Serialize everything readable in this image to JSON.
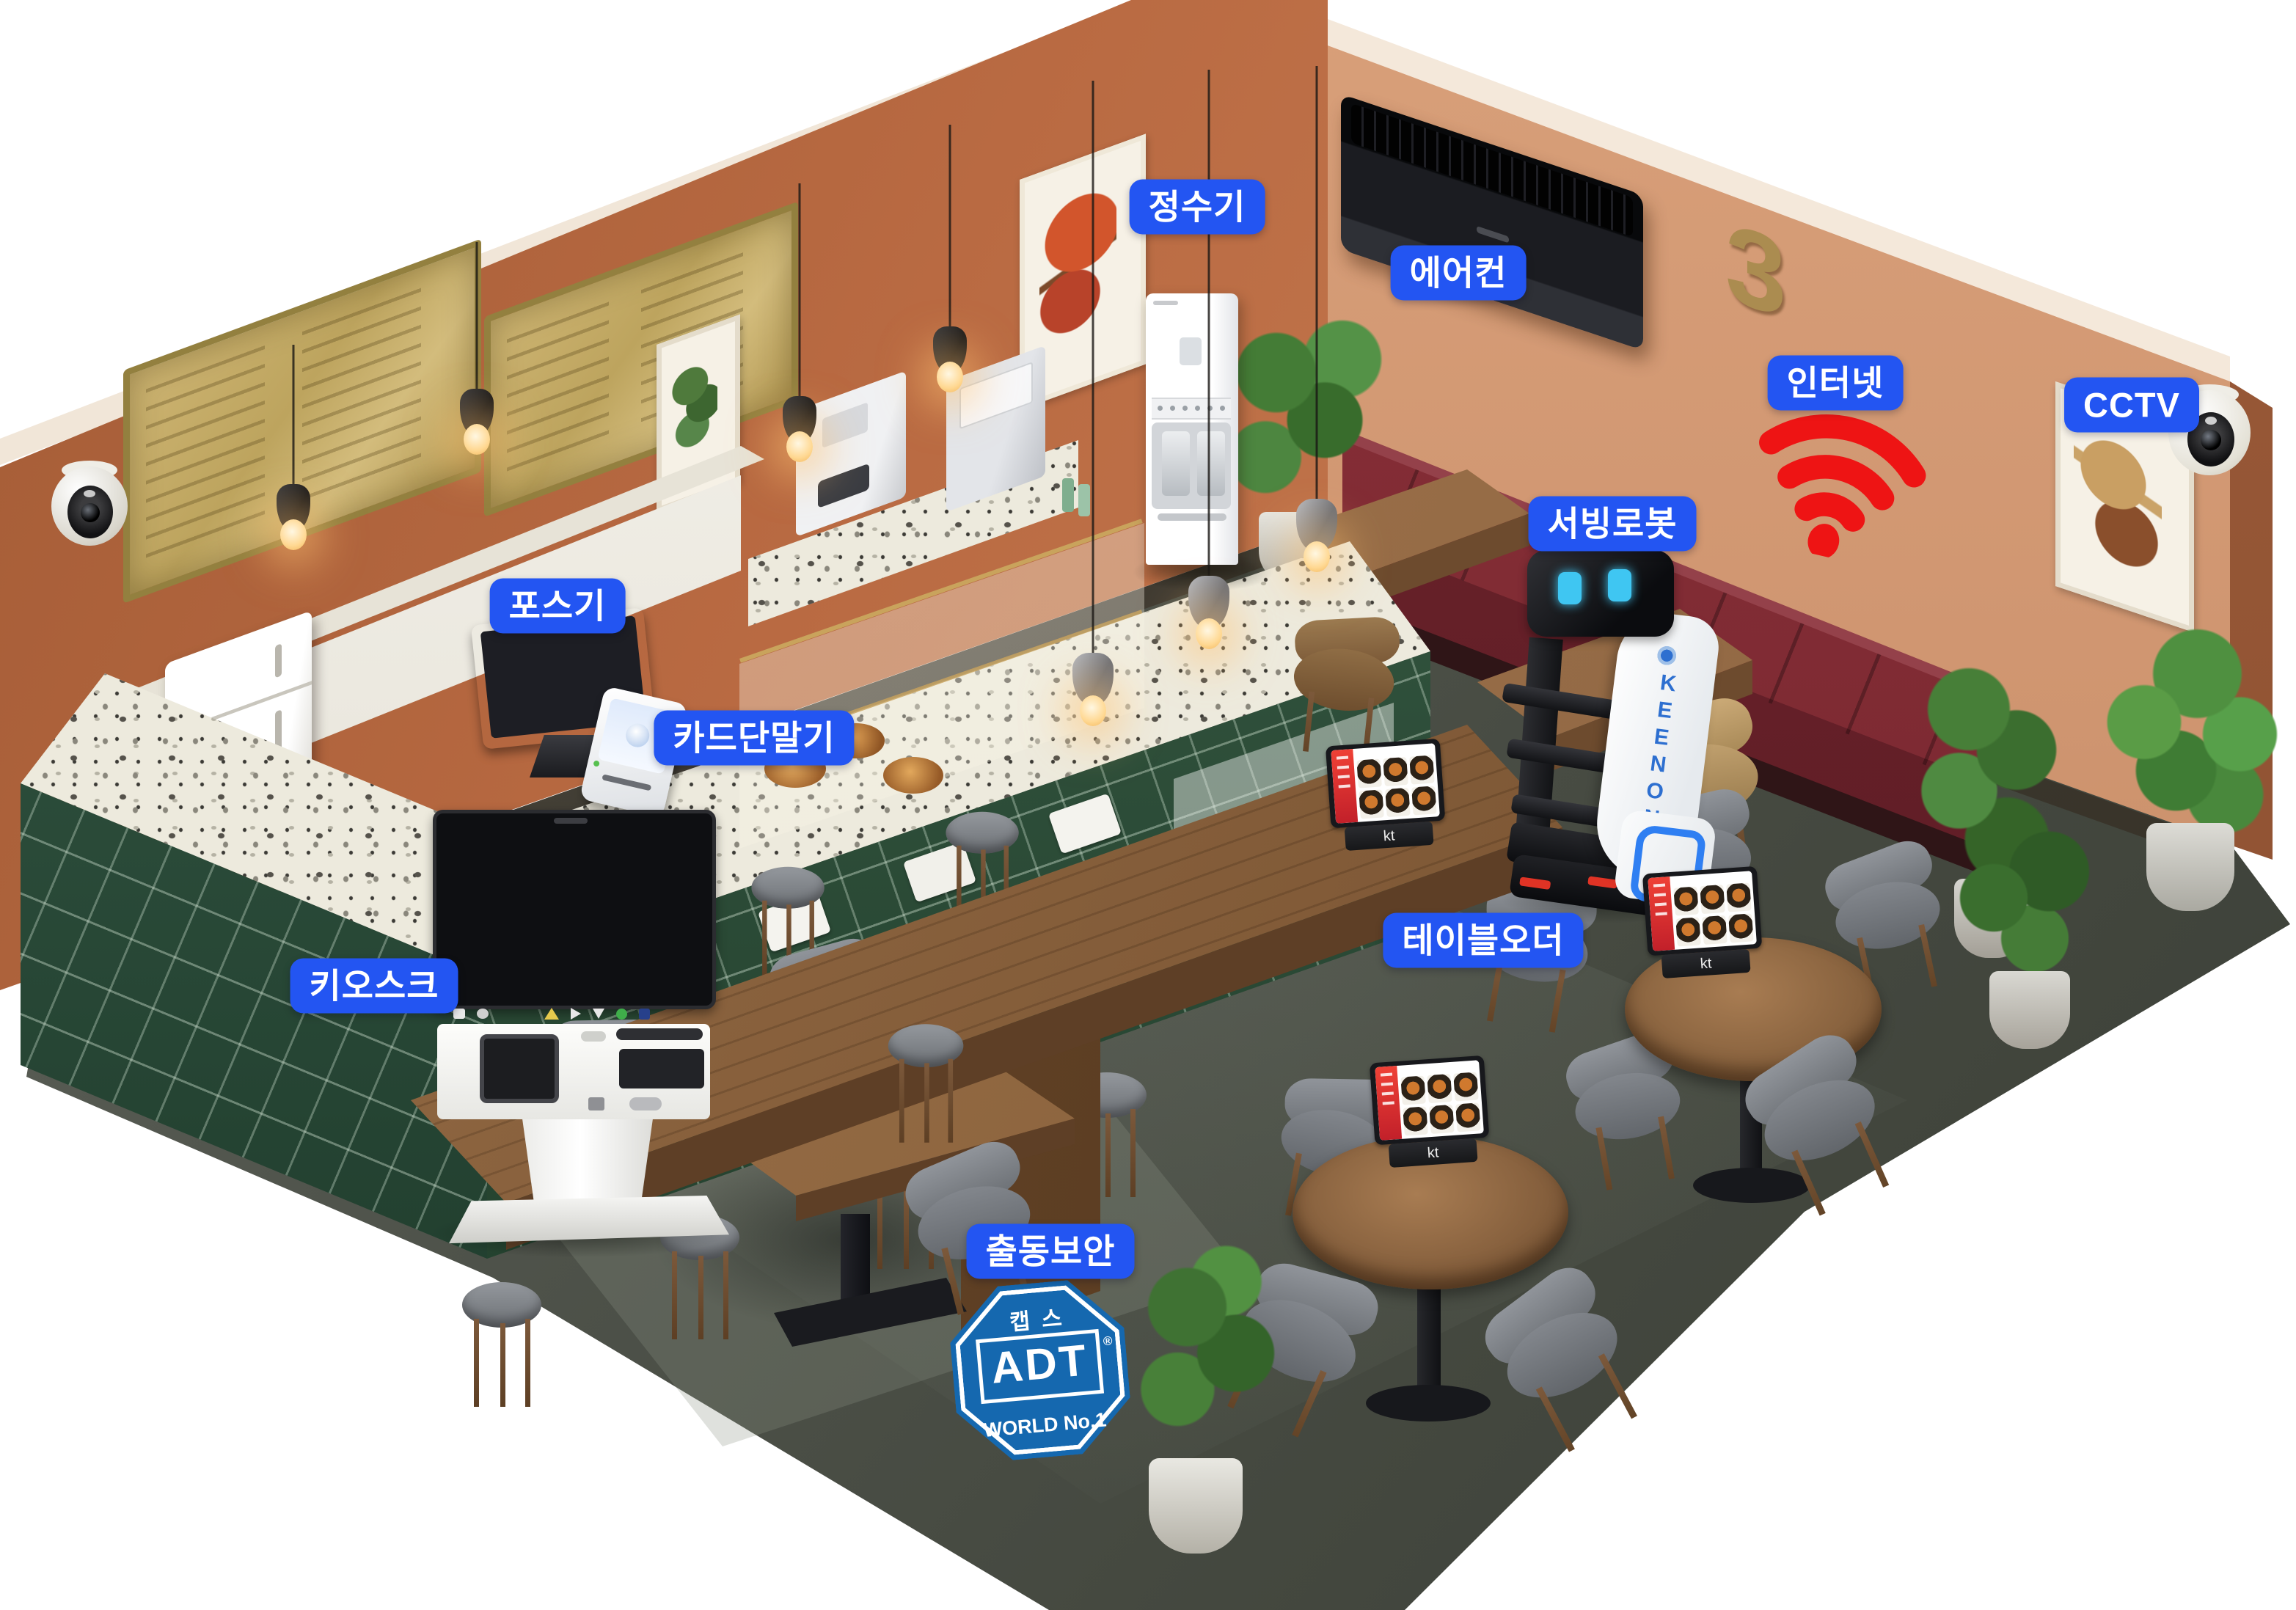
{
  "labels": {
    "water_purifier": "정수기",
    "air_conditioner": "에어컨",
    "internet": "인터넷",
    "cctv": "CCTV",
    "serving_robot": "서빙로봇",
    "pos": "포스기",
    "card_terminal": "카드단말기",
    "kiosk": "키오스크",
    "table_order": "테이블오더",
    "security": "출동보안"
  },
  "adt_badge": {
    "top": "캡스",
    "brand": "ADT",
    "reg": "®",
    "bottom": "WORLD No.1"
  },
  "devices": {
    "serving_robot_brand": "KEENON",
    "table_order_brand": "kt"
  },
  "wall_number": "3",
  "icons": {
    "internet": "wifi-icon",
    "cctv": "dome-camera-icon",
    "security": "adt-octagon-badge"
  },
  "colors": {
    "label_bg": "#2355f2",
    "label_text": "#ffffff",
    "wifi_red": "#ee1414",
    "adt_blue": "#1568af",
    "wall_back": "#b96a42",
    "wall_right": "#cf9570",
    "floor": "#51554d",
    "counter_tile": "#2a5138",
    "booth_leather": "#7c2a33",
    "gold": "#b3975c"
  }
}
